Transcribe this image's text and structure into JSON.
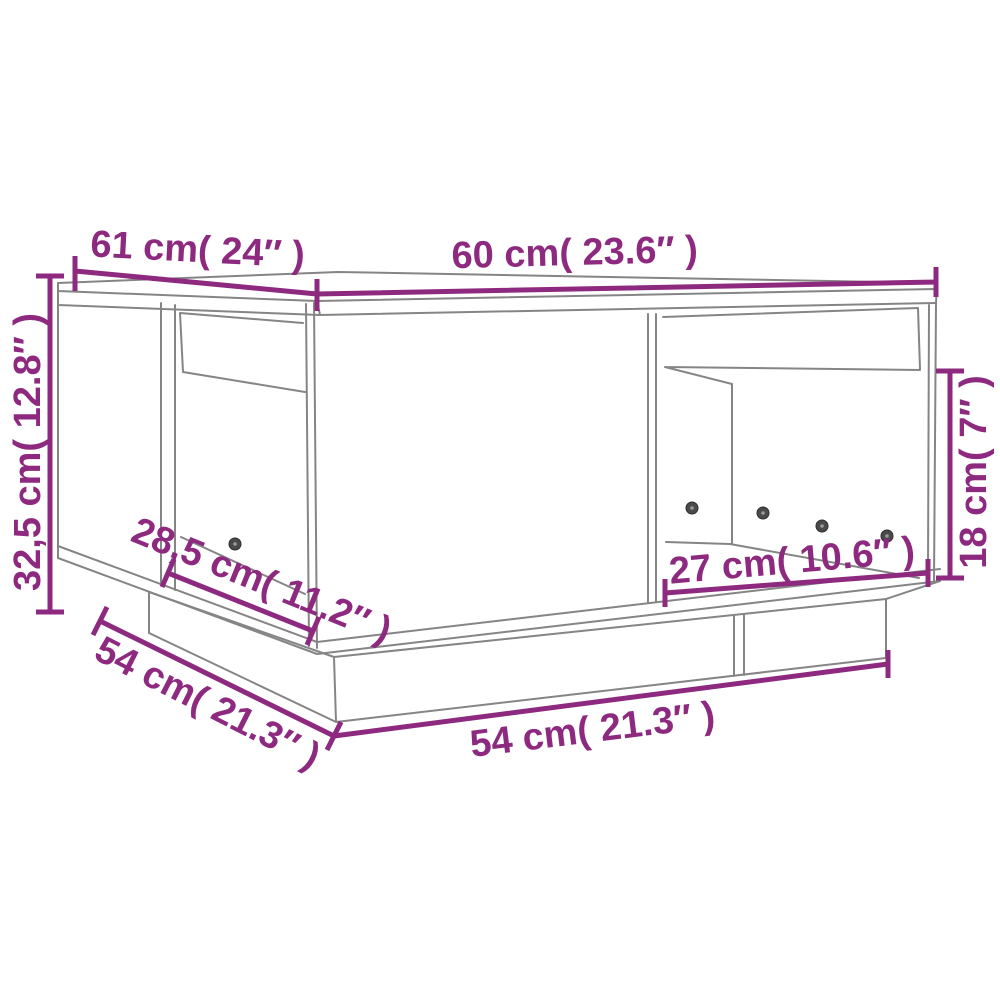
{
  "diagram": {
    "title": "coffee-table-dimension-diagram",
    "product": "coffee table with two open compartments",
    "colors": {
      "dimension": "#8d2a80",
      "drawing": "#858585",
      "background": "#ffffff"
    },
    "dimensions": [
      {
        "id": "top-left-edge-depth",
        "label": "61 cm( 24″ )"
      },
      {
        "id": "top-right-edge-width",
        "label": "60 cm( 23.6″ )"
      },
      {
        "id": "left-height",
        "label": "32,5 cm( 12.8″ )"
      },
      {
        "id": "left-opening-width",
        "label": "28,5 cm( 11.2″ )"
      },
      {
        "id": "base-left-edge-depth",
        "label": "54 cm( 21.3″ )"
      },
      {
        "id": "base-right-edge-width",
        "label": "54 cm( 21.3″ )"
      },
      {
        "id": "right-opening-width",
        "label": "27 cm( 10.6″ )"
      },
      {
        "id": "right-opening-height",
        "label": "18 cm( 7″ )"
      }
    ],
    "screw_count": 5
  }
}
